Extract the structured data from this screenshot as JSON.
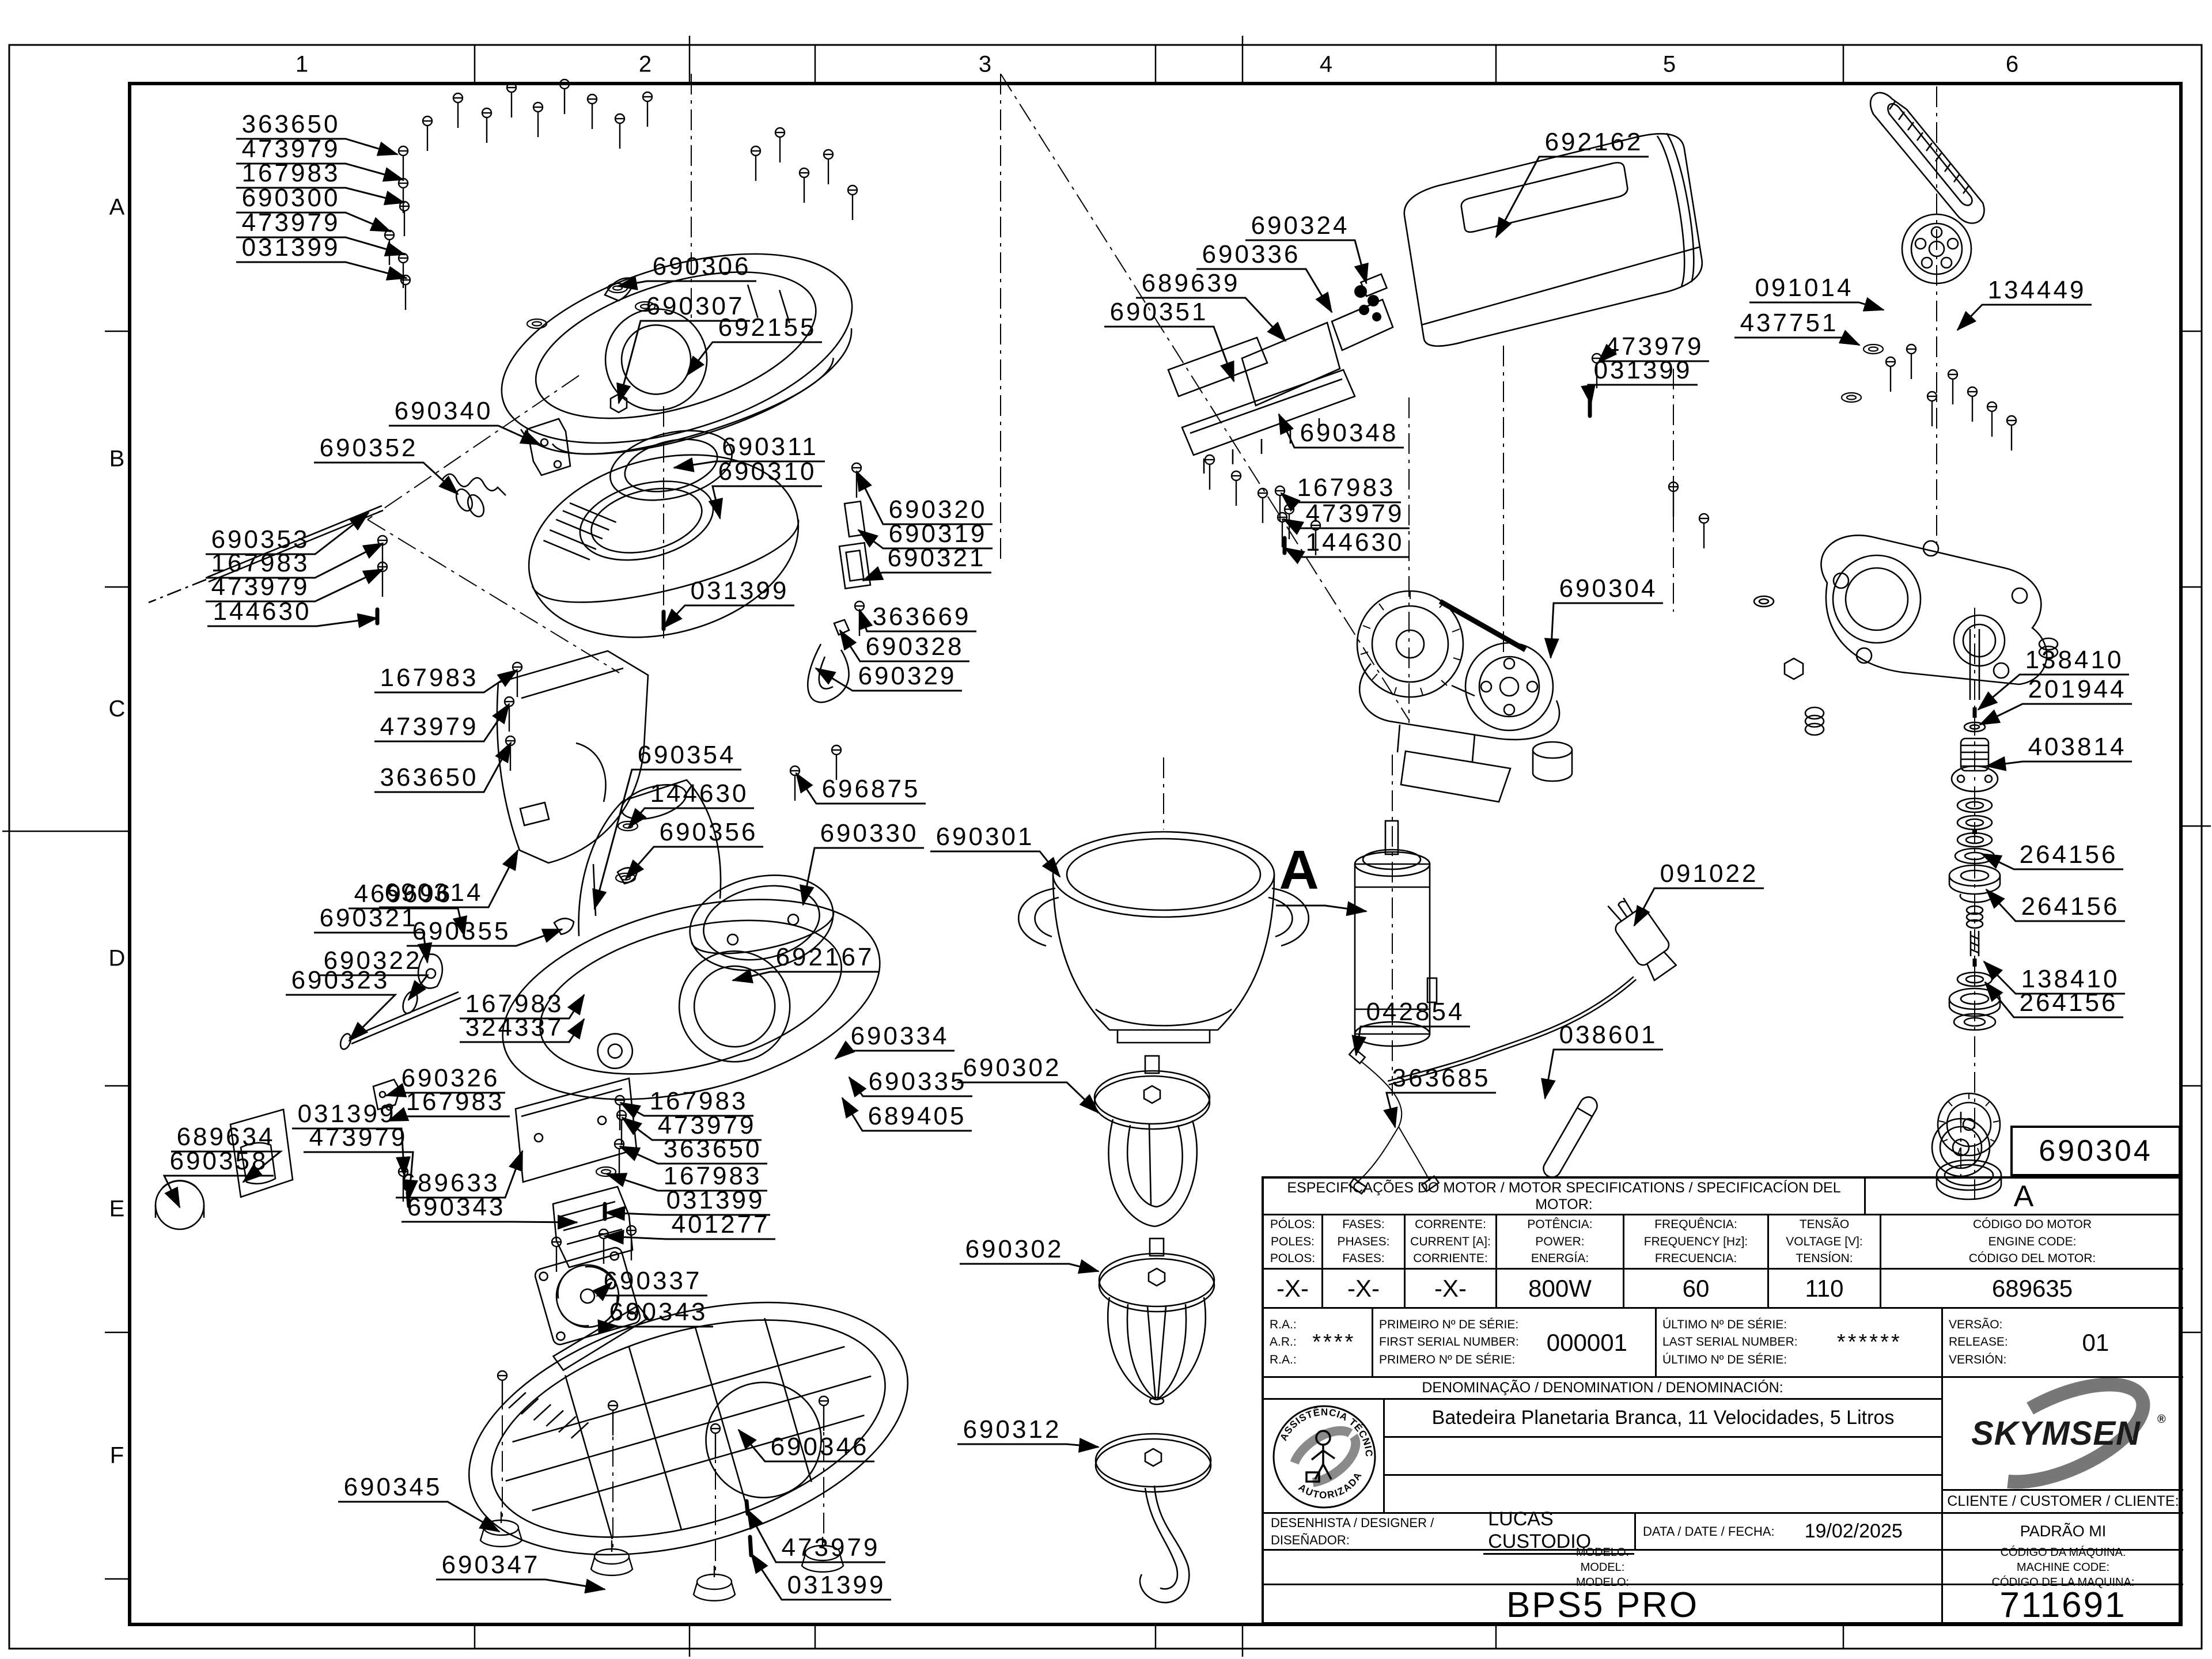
{
  "sheet": {
    "background": "#ffffff",
    "line_color": "#000000",
    "accent_gray": "#858585",
    "columns": [
      "1",
      "2",
      "3",
      "4",
      "5",
      "6"
    ],
    "rows": [
      "A",
      "B",
      "C",
      "D",
      "E",
      "F"
    ]
  },
  "detail_marker": {
    "text": "A"
  },
  "detail_box": {
    "part_number": "690304"
  },
  "labels": [
    [
      "363650",
      505,
      215,
      690,
      268
    ],
    [
      "473979",
      505,
      258,
      700,
      312
    ],
    [
      "167983",
      505,
      300,
      702,
      352
    ],
    [
      "690300",
      505,
      343,
      678,
      402
    ],
    [
      "473979",
      505,
      386,
      703,
      442
    ],
    [
      "031399",
      505,
      429,
      706,
      483
    ],
    [
      "690306",
      1218,
      462,
      1072,
      497
    ],
    [
      "690307",
      1207,
      531,
      1074,
      700
    ],
    [
      "692155",
      1332,
      568,
      1192,
      652
    ],
    [
      "690340",
      770,
      713,
      938,
      772
    ],
    [
      "690352",
      640,
      777,
      795,
      858
    ],
    [
      "690311",
      1337,
      775,
      1170,
      812
    ],
    [
      "690310",
      1332,
      818,
      1250,
      900
    ],
    [
      "690320",
      1628,
      884,
      1487,
      818
    ],
    [
      "690319",
      1628,
      926,
      1490,
      920
    ],
    [
      "690321",
      1626,
      968,
      1498,
      1008
    ],
    [
      "031399",
      1284,
      1025,
      1152,
      1090
    ],
    [
      "363669",
      1600,
      1070,
      1492,
      1058
    ],
    [
      "690328",
      1588,
      1122,
      1458,
      1094
    ],
    [
      "690329",
      1575,
      1173,
      1416,
      1160
    ],
    [
      "690353",
      452,
      936,
      640,
      890
    ],
    [
      "167983",
      452,
      977,
      665,
      943
    ],
    [
      "473979",
      452,
      1018,
      665,
      988
    ],
    [
      "144630",
      455,
      1061,
      655,
      1073
    ],
    [
      "167983",
      745,
      1176,
      898,
      1163
    ],
    [
      "473979",
      745,
      1261,
      884,
      1222
    ],
    [
      "363650",
      745,
      1349,
      887,
      1289
    ],
    [
      "690354",
      1192,
      1310,
      1032,
      1578
    ],
    [
      "144630",
      1214,
      1377,
      1091,
      1437
    ],
    [
      "690356",
      1230,
      1444,
      1086,
      1526
    ],
    [
      "696875",
      1512,
      1369,
      1382,
      1342
    ],
    [
      "690330",
      1509,
      1446,
      1394,
      1571
    ],
    [
      "690314",
      753,
      1549,
      899,
      1476
    ],
    [
      "690355",
      801,
      1616,
      976,
      1613
    ],
    [
      "690301",
      1710,
      1452,
      1840,
      1522
    ],
    [
      "469696",
      700,
      1551,
      806,
      1625
    ],
    [
      "690321",
      640,
      1593,
      742,
      1671
    ],
    [
      "690322",
      647,
      1667,
      709,
      1736
    ],
    [
      "690323",
      591,
      1701,
      606,
      1807
    ],
    [
      "692167",
      1432,
      1661,
      1272,
      1702
    ],
    [
      "167983",
      893,
      1742,
      1014,
      1727
    ],
    [
      "324337",
      893,
      1783,
      1014,
      1769
    ],
    [
      "690334",
      1562,
      1798,
      1450,
      1838
    ],
    [
      "690335",
      1593,
      1877,
      1474,
      1870
    ],
    [
      "689405",
      1592,
      1937,
      1462,
      1906
    ],
    [
      "690326",
      782,
      1871,
      670,
      1902
    ],
    [
      "167983",
      790,
      1912,
      674,
      1946
    ],
    [
      "031399",
      602,
      1933,
      702,
      2042
    ],
    [
      "473979",
      622,
      1974,
      710,
      2082
    ],
    [
      "689634",
      392,
      1973,
      422,
      2052
    ],
    [
      "690358",
      380,
      2015,
      312,
      2096
    ],
    [
      "689633",
      782,
      2053,
      907,
      1998
    ],
    [
      "690343",
      792,
      2095,
      1002,
      2122
    ],
    [
      "167983",
      1213,
      1911,
      1077,
      1914
    ],
    [
      "473979",
      1227,
      1953,
      1080,
      1940
    ],
    [
      "363650",
      1237,
      1994,
      1076,
      1990
    ],
    [
      "167983",
      1237,
      2041,
      1053,
      2038
    ],
    [
      "031399",
      1242,
      2083,
      1051,
      2105
    ],
    [
      "401277",
      1251,
      2125,
      1049,
      2146
    ],
    [
      "690337",
      1133,
      2223,
      1062,
      2226
    ],
    [
      "690343",
      1143,
      2277,
      1072,
      2302
    ],
    [
      "690346",
      1423,
      2511,
      1282,
      2482
    ],
    [
      "690345",
      682,
      2581,
      867,
      2659
    ],
    [
      "473979",
      1442,
      2686,
      1297,
      2620
    ],
    [
      "690347",
      852,
      2716,
      1050,
      2759
    ],
    [
      "031399",
      1452,
      2751,
      1304,
      2697
    ],
    [
      "690302",
      1757,
      1853,
      1907,
      1932
    ],
    [
      "690302",
      1761,
      2168,
      1907,
      2207
    ],
    [
      "690312",
      1757,
      2481,
      1907,
      2512
    ],
    [
      "692162",
      2767,
      246,
      2597,
      412
    ],
    [
      "690324",
      2257,
      391,
      2372,
      492
    ],
    [
      "690336",
      2172,
      441,
      2312,
      542
    ],
    [
      "689639",
      2067,
      491,
      2232,
      592
    ],
    [
      "690351",
      2012,
      541,
      2142,
      662
    ],
    [
      "473979",
      2872,
      601,
      2774,
      630
    ],
    [
      "031399",
      2852,
      642,
      2762,
      702
    ],
    [
      "690348",
      2342,
      751,
      2220,
      719
    ],
    [
      "167983",
      2337,
      846,
      2224,
      856
    ],
    [
      "473979",
      2352,
      891,
      2228,
      901
    ],
    [
      "144630",
      2352,
      941,
      2230,
      951
    ],
    [
      "690304",
      2792,
      1021,
      2692,
      1142
    ],
    [
      "091022",
      2967,
      1516,
      2837,
      1607
    ],
    [
      "042854",
      2457,
      1756,
      2354,
      1832
    ],
    [
      "038601",
      2792,
      1796,
      2682,
      1907
    ],
    [
      "363685",
      2502,
      1871,
      2422,
      1957
    ],
    [
      "091014",
      3132,
      499,
      3270,
      538
    ],
    [
      "437751",
      3106,
      560,
      3228,
      599
    ],
    [
      "134449",
      3536,
      503,
      3398,
      573
    ],
    [
      "138410",
      3601,
      1145,
      3434,
      1232
    ],
    [
      "201944",
      3606,
      1196,
      3437,
      1258
    ],
    [
      "403814",
      3606,
      1296,
      3448,
      1330
    ],
    [
      "264156",
      3591,
      1483,
      3440,
      1482
    ],
    [
      "264156",
      3594,
      1573,
      3448,
      1544
    ],
    [
      "138410",
      3594,
      1699,
      3444,
      1669
    ],
    [
      "264156",
      3591,
      1740,
      3446,
      1705
    ]
  ],
  "title_block": {
    "spec_header": "ESPECIFICAÇÕES DO MOTOR / MOTOR SPECIFICATIONS / SPECIFICACÍON DEL MOTOR:",
    "revision": "A",
    "spec_columns": [
      {
        "lines": [
          "PÓLOS:",
          "POLES:",
          "POLOS:"
        ],
        "value": "-X-"
      },
      {
        "lines": [
          "FASES:",
          "PHASES:",
          "FASES:"
        ],
        "value": "-X-"
      },
      {
        "lines": [
          "CORRENTE:",
          "CURRENT [A]:",
          "CORRIENTE:"
        ],
        "value": "-X-"
      },
      {
        "lines": [
          "POTÊNCIA:",
          "POWER:",
          "ENERGÍA:"
        ],
        "value": "800W"
      },
      {
        "lines": [
          "FREQUÊNCIA:",
          "FREQUENCY [Hz]:",
          "FRECUENCIA:"
        ],
        "value": "60"
      },
      {
        "lines": [
          "TENSÃO",
          "VOLTAGE [V]:",
          "TENSÍON:"
        ],
        "value": "110"
      },
      {
        "lines": [
          "CÓDIGO DO MOTOR",
          "ENGINE CODE:",
          "CÓDIGO DEL MOTOR:"
        ],
        "value": "689635"
      }
    ],
    "ra": {
      "lines": [
        "R.A.:",
        "A.R.:",
        "R.A.:"
      ],
      "value": "****"
    },
    "first_serial": {
      "lines": [
        "PRIMEIRO Nº DE SÉRIE:",
        "FIRST SERIAL NUMBER:",
        "PRIMERO Nº DE SÉRIE:"
      ],
      "value": "000001"
    },
    "last_serial": {
      "lines": [
        "ÚLTIMO Nº DE SÉRIE:",
        "LAST SERIAL NUMBER:",
        "ÚLTIMO Nº DE SÉRIE:"
      ],
      "value": "******"
    },
    "version": {
      "lines": [
        "VERSÃO:",
        "RELEASE:",
        "VERSIÓN:"
      ],
      "value": "01"
    },
    "denomination_header": "DENOMINAÇÃO / DENOMINATION / DENOMINACIÓN:",
    "denomination": "Batedeira Planetaria Branca, 11 Velocidades, 5 Litros",
    "stamp": {
      "arc_top": "ASSISTÊNCIA TÉCNICA",
      "arc_bottom": "AUTORIZADA"
    },
    "brand": "SKYMSEN",
    "brand_reg": "®",
    "client_label": "CLIENTE / CUSTOMER / CLIENTE:",
    "designer_label": "DESENHISTA / DESIGNER / DISEÑADOR:",
    "designer": "LUCAS CUSTODIO",
    "date_label": "DATA / DATE / FECHA:",
    "date": "19/02/2025",
    "padrao": "PADRÃO MI",
    "model_label_lines": [
      "MODELO:",
      "MODEL:",
      "MODELO:"
    ],
    "machine_code_lines": [
      "CÓDIGO DA MÁQUINA:",
      "MACHINE CODE:",
      "CÓDIGO DE LA MAQUINA:"
    ],
    "model_value": "BPS5 PRO",
    "machine_code_value": "711691"
  }
}
